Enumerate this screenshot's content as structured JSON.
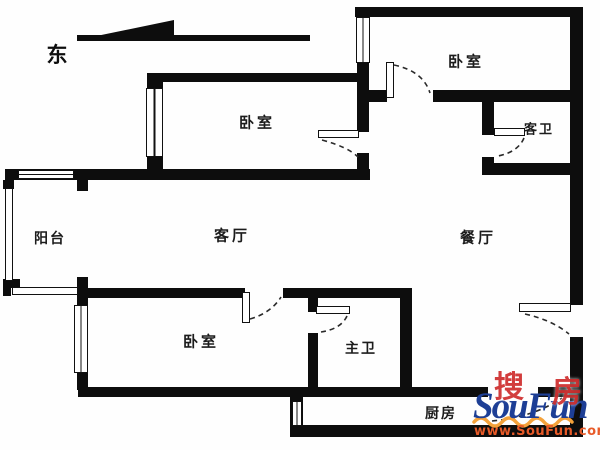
{
  "compass": {
    "direction_label": "东"
  },
  "rooms": {
    "bedroom_top_left": "卧室",
    "bedroom_top_right": "卧室",
    "guest_bath": "客卫",
    "balcony": "阳台",
    "living_room": "客厅",
    "dining_room": "餐厅",
    "bedroom_bottom": "卧室",
    "master_bath": "主卫",
    "kitchen": "厨房"
  },
  "watermark": {
    "brand": "SouFun",
    "brand_cn_first": "搜",
    "brand_cn_second": "房",
    "url": "www.SouFun.com",
    "brand_color": "#1d3e95",
    "cn_color": "#cc2222",
    "url_color": "#e85a28",
    "wave_color": "#f4a23b"
  },
  "colors": {
    "wall": "#0d0d0d",
    "background": "#ffffff",
    "label_text": "#1c1c1c"
  }
}
